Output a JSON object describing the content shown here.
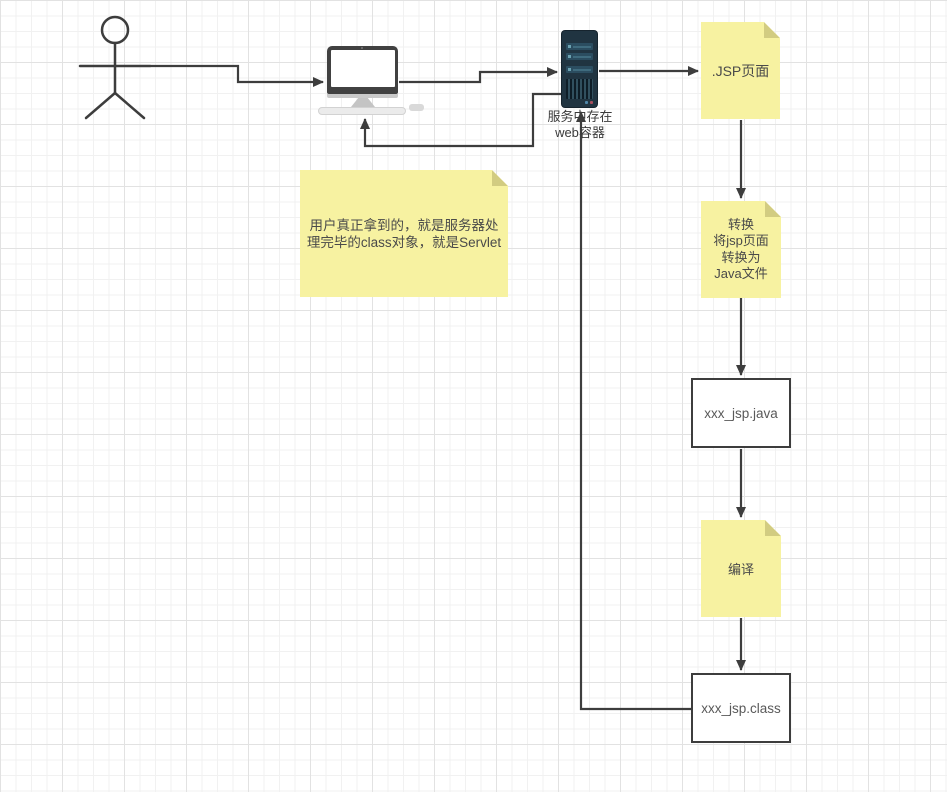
{
  "diagram": {
    "title_hint": "JSP to Servlet flow diagram",
    "server": {
      "label": "服务中存在\nweb容器"
    },
    "notes": {
      "jsp": {
        "text": ".JSP页面"
      },
      "convert": {
        "text": "转换\n将jsp页面\n转换为\nJava文件"
      },
      "compile": {
        "text": "编译"
      },
      "comment": {
        "text": "用户真正拿到的，就是服务器处\n理完毕的class对象，就是Servlet"
      }
    },
    "boxes": {
      "java": {
        "label": "xxx_jsp.java"
      },
      "class": {
        "label": "xxx_jsp.class"
      }
    },
    "colors": {
      "note_fill": "#f7f2a1",
      "note_fold": "#d2cc81",
      "server_body": "#203441",
      "server_slot": "#2b4d60",
      "server_led_blue": "#4e86a8",
      "server_led_red": "#a84e5e",
      "connector": "#3d3d3d",
      "grid_minor": "#f1f1f1",
      "grid_major": "#e2e2e2",
      "box_border": "#3d3d3d"
    }
  }
}
